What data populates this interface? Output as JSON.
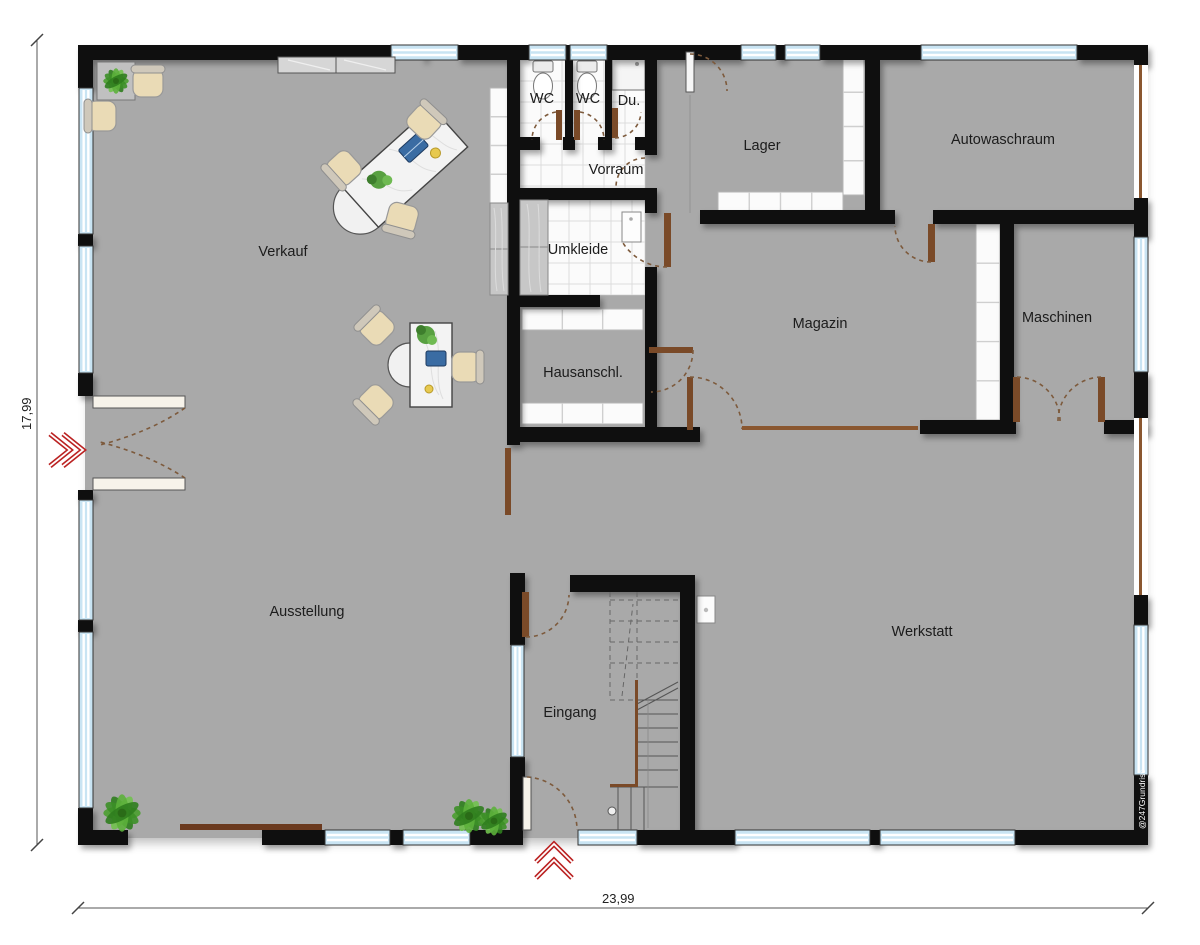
{
  "plan": {
    "rooms": {
      "verkauf": {
        "label": "Verkauf"
      },
      "ausstellung": {
        "label": "Ausstellung"
      },
      "wc1": {
        "label": "WC"
      },
      "wc2": {
        "label": "WC"
      },
      "du": {
        "label": "Du."
      },
      "vorraum": {
        "label": "Vorraum"
      },
      "umkleide": {
        "label": "Umkleide"
      },
      "hausanschl": {
        "label": "Hausanschl."
      },
      "lager": {
        "label": "Lager"
      },
      "autowaschraum": {
        "label": "Autowaschraum"
      },
      "magazin": {
        "label": "Magazin"
      },
      "maschinen": {
        "label": "Maschinen"
      },
      "werkstatt": {
        "label": "Werkstatt"
      },
      "eingang": {
        "label": "Eingang"
      }
    },
    "dimensions": {
      "height_label": "17,99",
      "width_label": "23,99"
    },
    "watermark": "@247Grundriss",
    "markers": {
      "side_entrance_icon": "double-chevron-right",
      "front_entrance_icon": "double-chevron-up"
    },
    "colors": {
      "floor": "#a9a9a9",
      "wall": "#0f0f0f",
      "window_glass": "#c9e4f3",
      "tile": "#fbfbfb",
      "tile_grid": "#dddddd",
      "door_leaf": "#7a4a28",
      "open_partition": "#8a5730",
      "entry_arrow": "#bb2222",
      "chair_seat": "#eadbb6",
      "plant_green": "#4a9e2f",
      "shelf_white": "#fbfbfb",
      "dim_line": "#555555"
    }
  }
}
